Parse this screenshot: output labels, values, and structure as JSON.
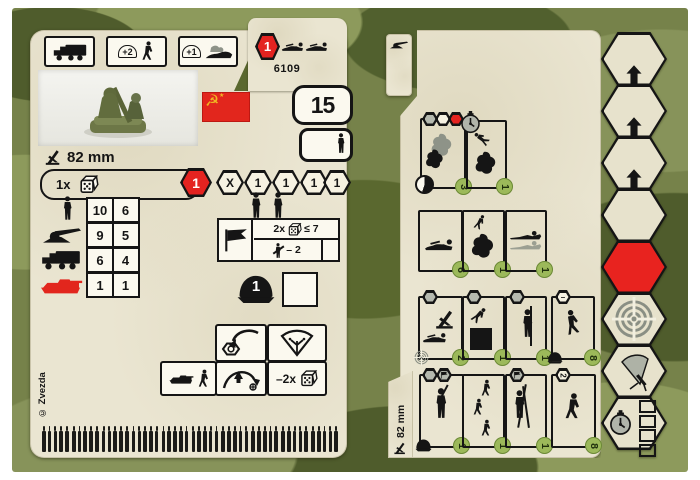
{
  "colors": {
    "camo_base": "#76824a",
    "camo_dark": "#4f5c2c",
    "camo_light": "#8d9a5c",
    "parchment": "#eae5d1",
    "accent_red": "#e42320",
    "badge_green": "#9cb95a",
    "hex_gray": "#b5b9af",
    "ink": "#151515",
    "flag_gold": "#f0b823"
  },
  "left_card": {
    "header": {
      "class_hex_value": "1",
      "set_number": "6109",
      "modifier_plus2": "+2",
      "modifier_plus1": "+1"
    },
    "flag": {
      "emblem": "☭",
      "star": "★"
    },
    "points_value": "15",
    "caliber_label": "82 mm",
    "attack_row": {
      "prefix": "1x",
      "hexes": [
        "1",
        "X",
        "1",
        "1",
        "1",
        "1"
      ]
    },
    "stat_table": {
      "rows": [
        {
          "target": "infantry",
          "near": "10",
          "far": "6"
        },
        {
          "target": "gun",
          "near": "9",
          "far": "5"
        },
        {
          "target": "truck",
          "near": "6",
          "far": "4"
        },
        {
          "target": "tank",
          "near": "1",
          "far": "1"
        }
      ]
    },
    "spotter_box": {
      "multiplier": "2x",
      "threshold": "≤ 7",
      "penalty": "– 2"
    },
    "armor_value": "1",
    "indirect_penalty": "–2x",
    "copyright": "© Zvezda",
    "ammo": {
      "groups": 10,
      "per_group": 5
    }
  },
  "right_card": {
    "caliber_label": "82 mm",
    "order_grid": {
      "row1": [
        {
          "badge": "3"
        },
        {
          "badge": "1"
        }
      ],
      "row2": [
        {
          "badge": "6"
        },
        {
          "badge": "1"
        },
        {
          "badge": "1"
        }
      ],
      "row3": [
        {
          "badge": "2"
        },
        {
          "badge": "1"
        },
        {
          "badge": "1"
        },
        {
          "badge": "8",
          "hex_label": "–"
        }
      ],
      "row4": [
        {
          "badge": "1"
        },
        {
          "badge": "1"
        },
        {
          "badge": "1"
        },
        {
          "badge": "8",
          "hex_label": "2"
        }
      ]
    }
  }
}
